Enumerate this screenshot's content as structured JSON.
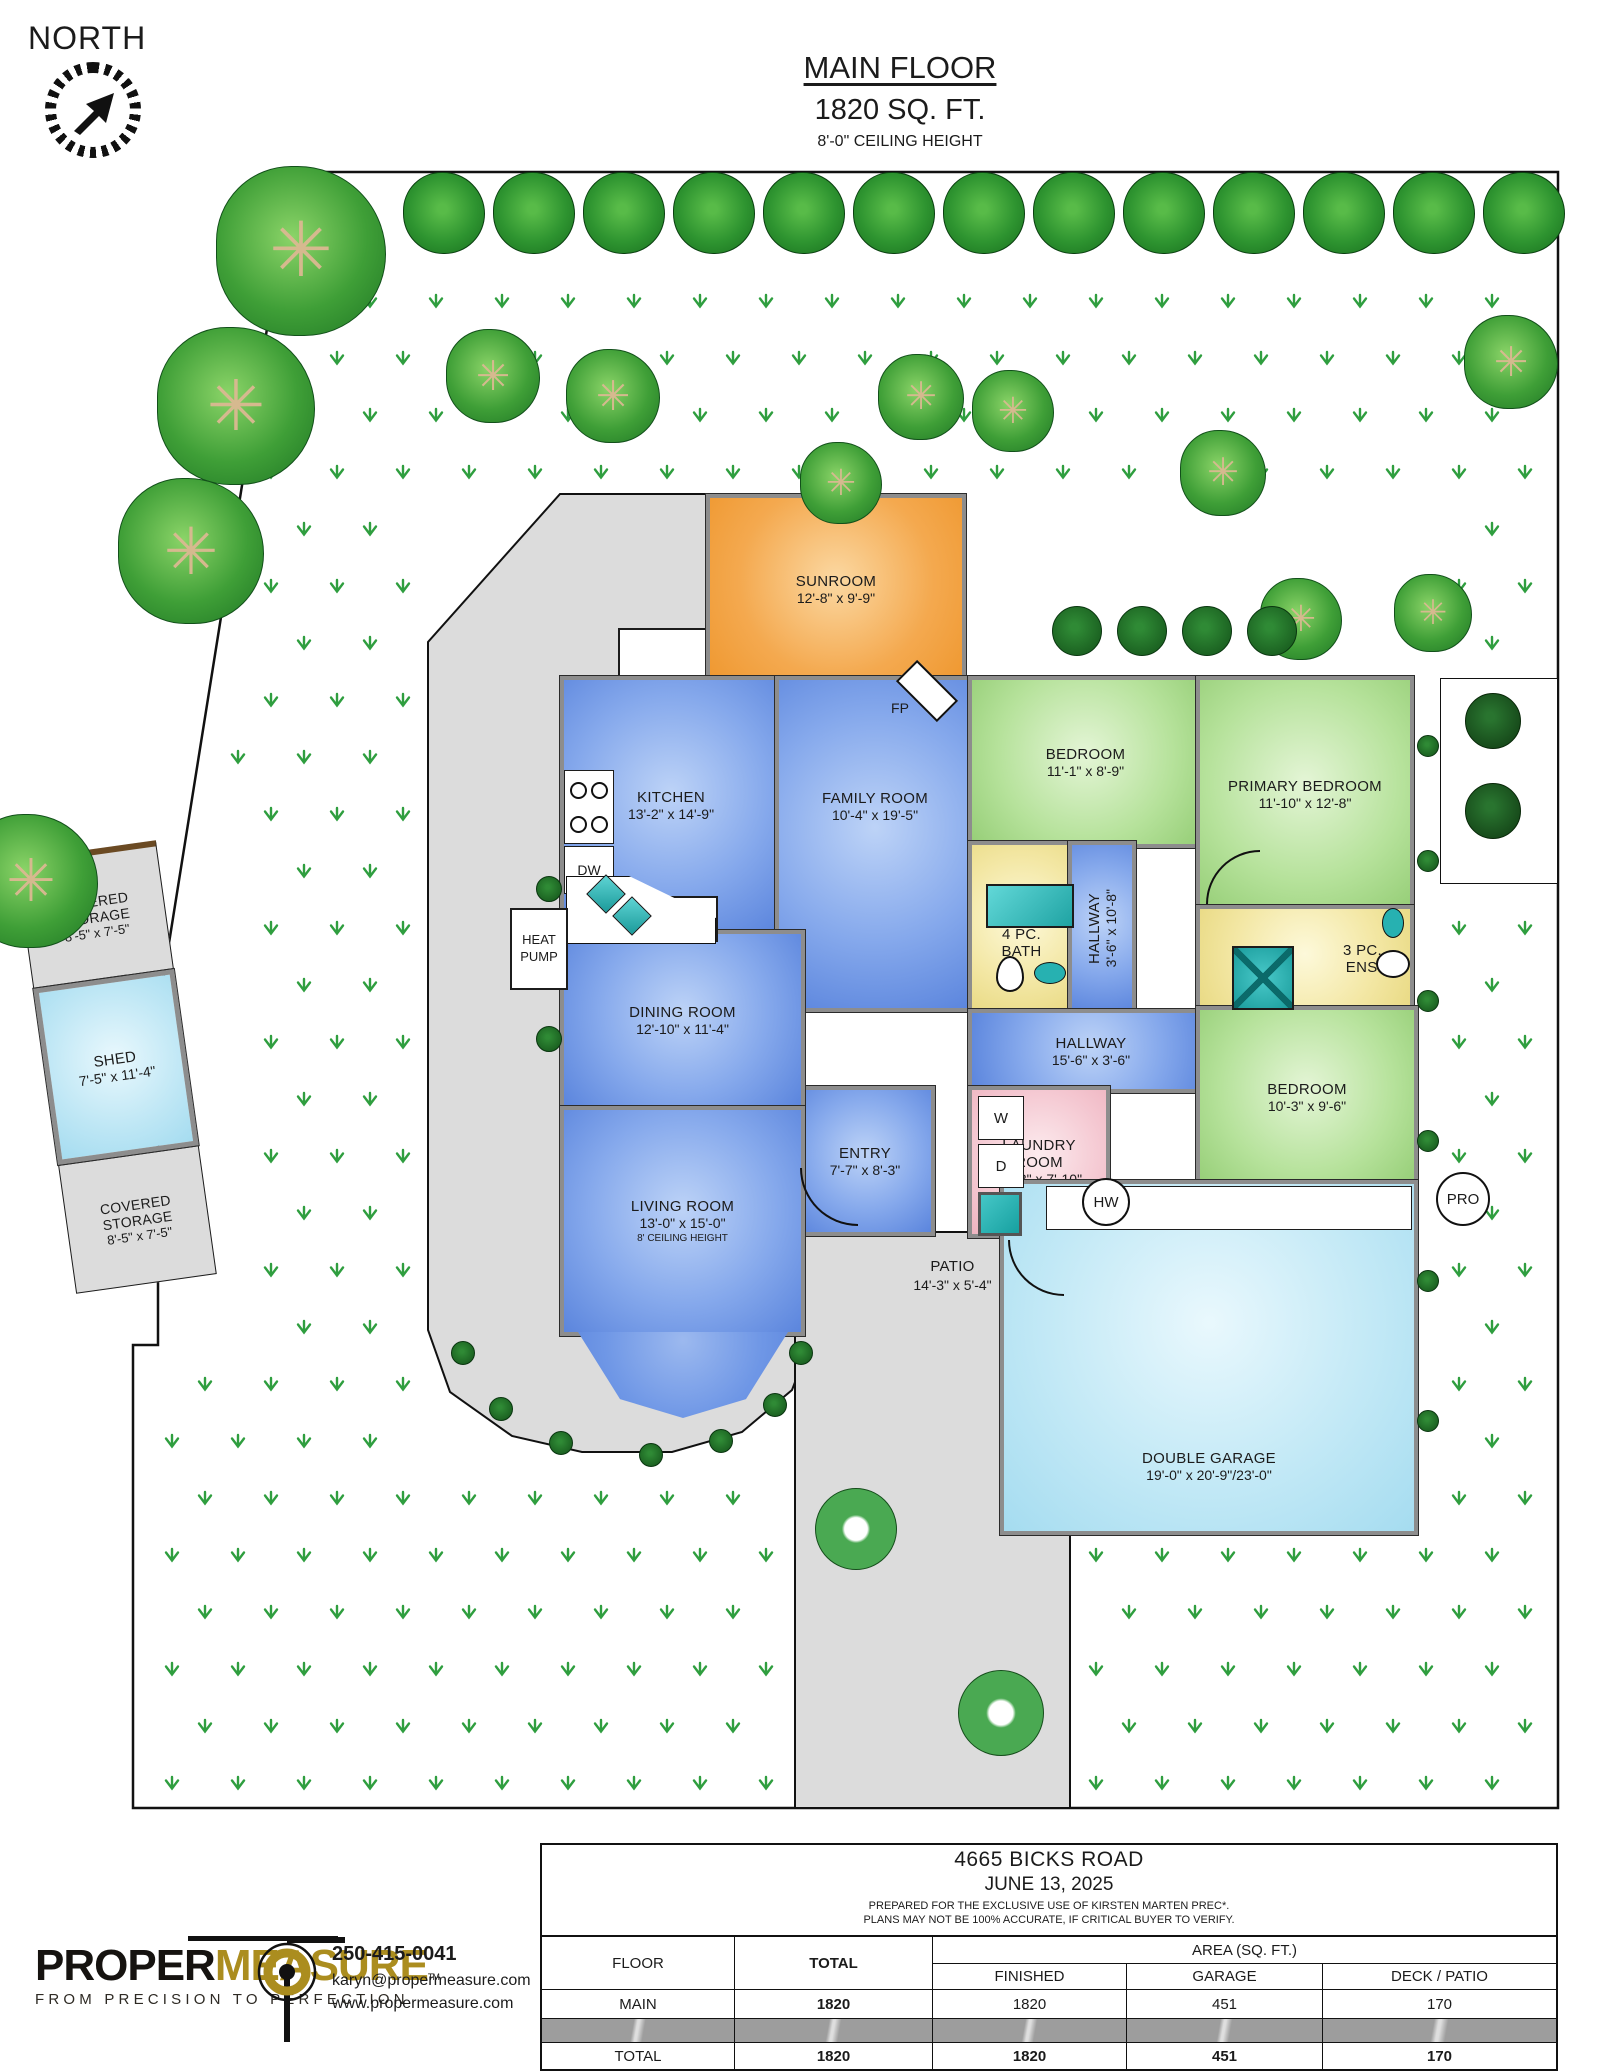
{
  "north_label": "NORTH",
  "title": {
    "line1": "MAIN FLOOR",
    "line2": "1820 SQ. FT.",
    "line3": "8'-0\" CEILING HEIGHT"
  },
  "rooms": {
    "sunroom": {
      "name": "SUNROOM",
      "dims": "12'-8\" x 9'-9\""
    },
    "kitchen": {
      "name": "KITCHEN",
      "dims": "13'-2\" x 14'-9\""
    },
    "family": {
      "name": "FAMILY ROOM",
      "dims": "10'-4\" x 19'-5\""
    },
    "dining": {
      "name": "DINING ROOM",
      "dims": "12'-10\" x 11'-4\""
    },
    "living": {
      "name": "LIVING ROOM",
      "dims": "13'-0\" x 15'-0\"",
      "note": "8' CEILING HEIGHT"
    },
    "bedroom_top": {
      "name": "BEDROOM",
      "dims": "11'-1\" x 8'-9\""
    },
    "primary": {
      "name": "PRIMARY BEDROOM",
      "dims": "11'-10\" x 12'-8\""
    },
    "bath": {
      "line1": "4 PC.",
      "line2": "BATH"
    },
    "ens": {
      "line1": "3 PC.",
      "line2": "ENS."
    },
    "hall_v": {
      "name": "HALLWAY",
      "dims": "3'-6\" x 10'-8\""
    },
    "hall_h": {
      "name": "HALLWAY",
      "dims": "15'-6\" x 3'-6\""
    },
    "entry": {
      "name": "ENTRY",
      "dims": "7'-7\" x 8'-3\""
    },
    "laundry": {
      "line1": "LAUNDRY",
      "line2": "ROOM",
      "dims": "10'-3\" x 7'-10\""
    },
    "bedroom_br": {
      "name": "BEDROOM",
      "dims": "10'-3\" x 9'-6\""
    },
    "garage": {
      "name": "DOUBLE GARAGE",
      "dims": "19'-0\" x 20'-9\"/23'-0\""
    },
    "patio": {
      "name": "PATIO",
      "dims": "14'-3\" x 5'-4\""
    },
    "storage_top": {
      "line1": "COVERED",
      "line2": "STORAGE",
      "dims": "8'-5\" x 7'-5\""
    },
    "shed": {
      "name": "SHED",
      "dims": "7'-5\" x 11'-4\""
    },
    "storage_bottom": {
      "line1": "COVERED",
      "line2": "STORAGE",
      "dims": "8'-5\" x 7'-5\""
    }
  },
  "fixtures": {
    "heat_pump_line1": "HEAT",
    "heat_pump_line2": "PUMP",
    "fridge": "FR",
    "dishwasher": "DW",
    "fireplace": "FP",
    "washer": "W",
    "dryer": "D",
    "hot_water": "HW",
    "pro": "PRO"
  },
  "footer": {
    "address": "4665 BICKS ROAD",
    "date": "JUNE 13, 2025",
    "disclaimer1": "PREPARED FOR THE EXCLUSIVE USE OF KIRSTEN MARTEN PREC*.",
    "disclaimer2": "PLANS MAY NOT BE 100% ACCURATE, IF CRITICAL BUYER TO VERIFY.",
    "table": {
      "col_floor": "FLOOR",
      "col_total": "TOTAL",
      "col_area": "AREA (SQ. FT.)",
      "col_finished": "FINISHED",
      "col_garage": "GARAGE",
      "col_deck": "DECK / PATIO",
      "rows": [
        {
          "floor": "MAIN",
          "total": "1820",
          "finished": "1820",
          "garage": "451",
          "deck": "170"
        },
        {
          "floor": "TOTAL",
          "total": "1820",
          "finished": "1820",
          "garage": "451",
          "deck": "170"
        }
      ]
    },
    "brand": {
      "word1": "PROPER",
      "word2": "MEASURE",
      "tm": "TM",
      "tagline": "FROM PRECISION TO PERFECTION",
      "phone": "250-415-0041",
      "email": "karyn@propermeasure.com",
      "website": "www.propermeasure.com",
      "gold": "#ab8d1f"
    }
  }
}
